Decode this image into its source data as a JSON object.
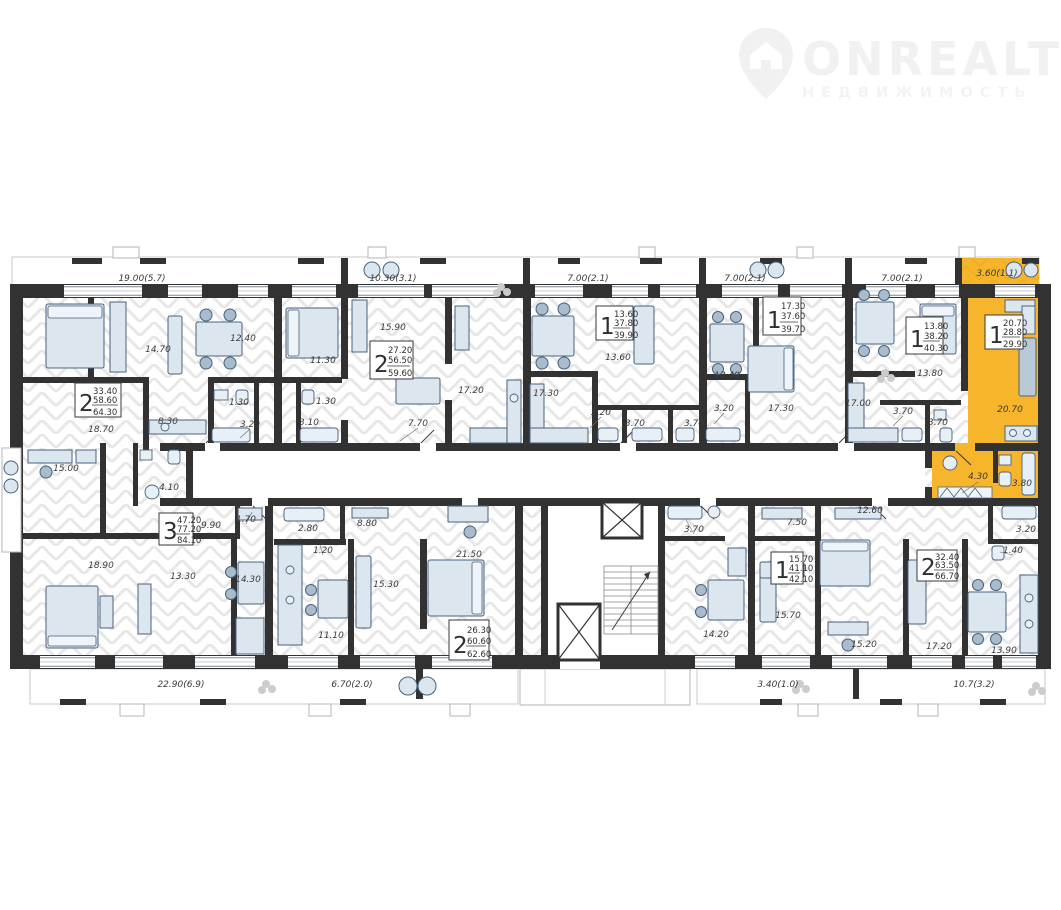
{
  "logo": {
    "title": "ONREALT",
    "subtitle": "НЕДВИЖИМОСТЬ"
  },
  "colors": {
    "wall": "#323232",
    "floor_hatch": "#e7e7e7",
    "highlight": "#f7b52c",
    "highlight_hatch": "#e2a41e",
    "furniture_fill": "#dce6ef",
    "furniture_stroke": "#48617c",
    "label_text": "#3a3a3a"
  },
  "plan": {
    "room_labels": [
      {
        "t": "19.00(5.7)",
        "x": 142,
        "y": 281
      },
      {
        "t": "10.30(3.1)",
        "x": 393,
        "y": 281
      },
      {
        "t": "7.00(2.1)",
        "x": 588,
        "y": 281
      },
      {
        "t": "7.00(2.1)",
        "x": 745,
        "y": 281
      },
      {
        "t": "7.00(2.1)",
        "x": 902,
        "y": 281
      },
      {
        "t": "3.60(1.1)",
        "x": 997,
        "y": 276
      },
      {
        "t": "14.70",
        "x": 158,
        "y": 352
      },
      {
        "t": "12.40",
        "x": 243,
        "y": 341
      },
      {
        "t": "18.70",
        "x": 101,
        "y": 432
      },
      {
        "t": "8.30",
        "x": 168,
        "y": 424
      },
      {
        "t": "1.30",
        "x": 239,
        "y": 405
      },
      {
        "t": "3.20",
        "x": 250,
        "y": 427
      },
      {
        "t": "11.30",
        "x": 323,
        "y": 363
      },
      {
        "t": "1.30",
        "x": 326,
        "y": 404
      },
      {
        "t": "3.10",
        "x": 309,
        "y": 425
      },
      {
        "t": "15.90",
        "x": 393,
        "y": 330
      },
      {
        "t": "7.70",
        "x": 418,
        "y": 426
      },
      {
        "t": "17.20",
        "x": 471,
        "y": 393
      },
      {
        "t": "13.60",
        "x": 618,
        "y": 360
      },
      {
        "t": "17.30",
        "x": 546,
        "y": 396
      },
      {
        "t": "3.20",
        "x": 601,
        "y": 415
      },
      {
        "t": "3.70",
        "x": 635,
        "y": 426
      },
      {
        "t": "3.70",
        "x": 694,
        "y": 426
      },
      {
        "t": "13.40",
        "x": 727,
        "y": 378
      },
      {
        "t": "3.20",
        "x": 724,
        "y": 411
      },
      {
        "t": "17.30",
        "x": 781,
        "y": 411
      },
      {
        "t": "17.00",
        "x": 858,
        "y": 406
      },
      {
        "t": "13.80",
        "x": 930,
        "y": 376
      },
      {
        "t": "3.70",
        "x": 903,
        "y": 414
      },
      {
        "t": "3.70",
        "x": 938,
        "y": 425
      },
      {
        "t": "20.70",
        "x": 1010,
        "y": 412
      },
      {
        "t": "4.30",
        "x": 978,
        "y": 479
      },
      {
        "t": "3.80",
        "x": 1022,
        "y": 486
      },
      {
        "t": "15.00",
        "x": 66,
        "y": 471
      },
      {
        "t": "4.10",
        "x": 169,
        "y": 490
      },
      {
        "t": "9.90",
        "x": 211,
        "y": 528
      },
      {
        "t": "1.70",
        "x": 246,
        "y": 522
      },
      {
        "t": "18.90",
        "x": 101,
        "y": 568
      },
      {
        "t": "13.30",
        "x": 183,
        "y": 579
      },
      {
        "t": "14.30",
        "x": 248,
        "y": 582
      },
      {
        "t": "22.90(6.9)",
        "x": 181,
        "y": 687
      },
      {
        "t": "2.80",
        "x": 308,
        "y": 531
      },
      {
        "t": "8.80",
        "x": 367,
        "y": 526
      },
      {
        "t": "1.20",
        "x": 323,
        "y": 553
      },
      {
        "t": "15.30",
        "x": 386,
        "y": 587
      },
      {
        "t": "21.50",
        "x": 469,
        "y": 557
      },
      {
        "t": "11.10",
        "x": 331,
        "y": 638
      },
      {
        "t": "6.70(2.0)",
        "x": 352,
        "y": 687
      },
      {
        "t": "3.70",
        "x": 694,
        "y": 532
      },
      {
        "t": "14.20",
        "x": 716,
        "y": 637
      },
      {
        "t": "7.50",
        "x": 797,
        "y": 525
      },
      {
        "t": "12.60",
        "x": 870,
        "y": 513
      },
      {
        "t": "15.70",
        "x": 788,
        "y": 618
      },
      {
        "t": "15.20",
        "x": 864,
        "y": 647
      },
      {
        "t": "17.20",
        "x": 939,
        "y": 649
      },
      {
        "t": "3.40(1.0)",
        "x": 778,
        "y": 687
      },
      {
        "t": "10.7(3.2)",
        "x": 974,
        "y": 687
      },
      {
        "t": "3.20",
        "x": 1026,
        "y": 532
      },
      {
        "t": "1.40",
        "x": 1013,
        "y": 553
      },
      {
        "t": "13.90",
        "x": 1004,
        "y": 653
      }
    ],
    "apartments": [
      {
        "rooms": "2",
        "values": [
          "33.40",
          "58.60",
          "64.30"
        ],
        "x": 75,
        "y": 383,
        "w": 46,
        "h": 34,
        "highlighted": false
      },
      {
        "rooms": "2",
        "values": [
          "27.20",
          "56.50",
          "59.60"
        ],
        "x": 370,
        "y": 341,
        "w": 43,
        "h": 38,
        "highlighted": false
      },
      {
        "rooms": "1",
        "values": [
          "13.60",
          "37.80",
          "39.90"
        ],
        "x": 596,
        "y": 306,
        "w": 37,
        "h": 34,
        "highlighted": false
      },
      {
        "rooms": "1",
        "values": [
          "17.30",
          "37.60",
          "39.70"
        ],
        "x": 763,
        "y": 297,
        "w": 38,
        "h": 38,
        "highlighted": false
      },
      {
        "rooms": "1",
        "values": [
          "13.80",
          "38.20",
          "40.30"
        ],
        "x": 906,
        "y": 317,
        "w": 37,
        "h": 37,
        "highlighted": false
      },
      {
        "rooms": "1",
        "values": [
          "20.70",
          "28.80",
          "29.90"
        ],
        "x": 985,
        "y": 315,
        "w": 38,
        "h": 34,
        "highlighted": true
      },
      {
        "rooms": "3",
        "values": [
          "47.20",
          "77.20",
          "84.10"
        ],
        "x": 159,
        "y": 513,
        "w": 34,
        "h": 32,
        "highlighted": false
      },
      {
        "rooms": "2",
        "values": [
          "26.30",
          "60.60",
          "62.60"
        ],
        "x": 449,
        "y": 620,
        "w": 40,
        "h": 40,
        "highlighted": false
      },
      {
        "rooms": "1",
        "values": [
          "15.70",
          "41.10",
          "42.10"
        ],
        "x": 771,
        "y": 552,
        "w": 32,
        "h": 32,
        "highlighted": false
      },
      {
        "rooms": "2",
        "values": [
          "32.40",
          "63.50",
          "66.70"
        ],
        "x": 917,
        "y": 550,
        "w": 40,
        "h": 31,
        "highlighted": false
      }
    ]
  }
}
